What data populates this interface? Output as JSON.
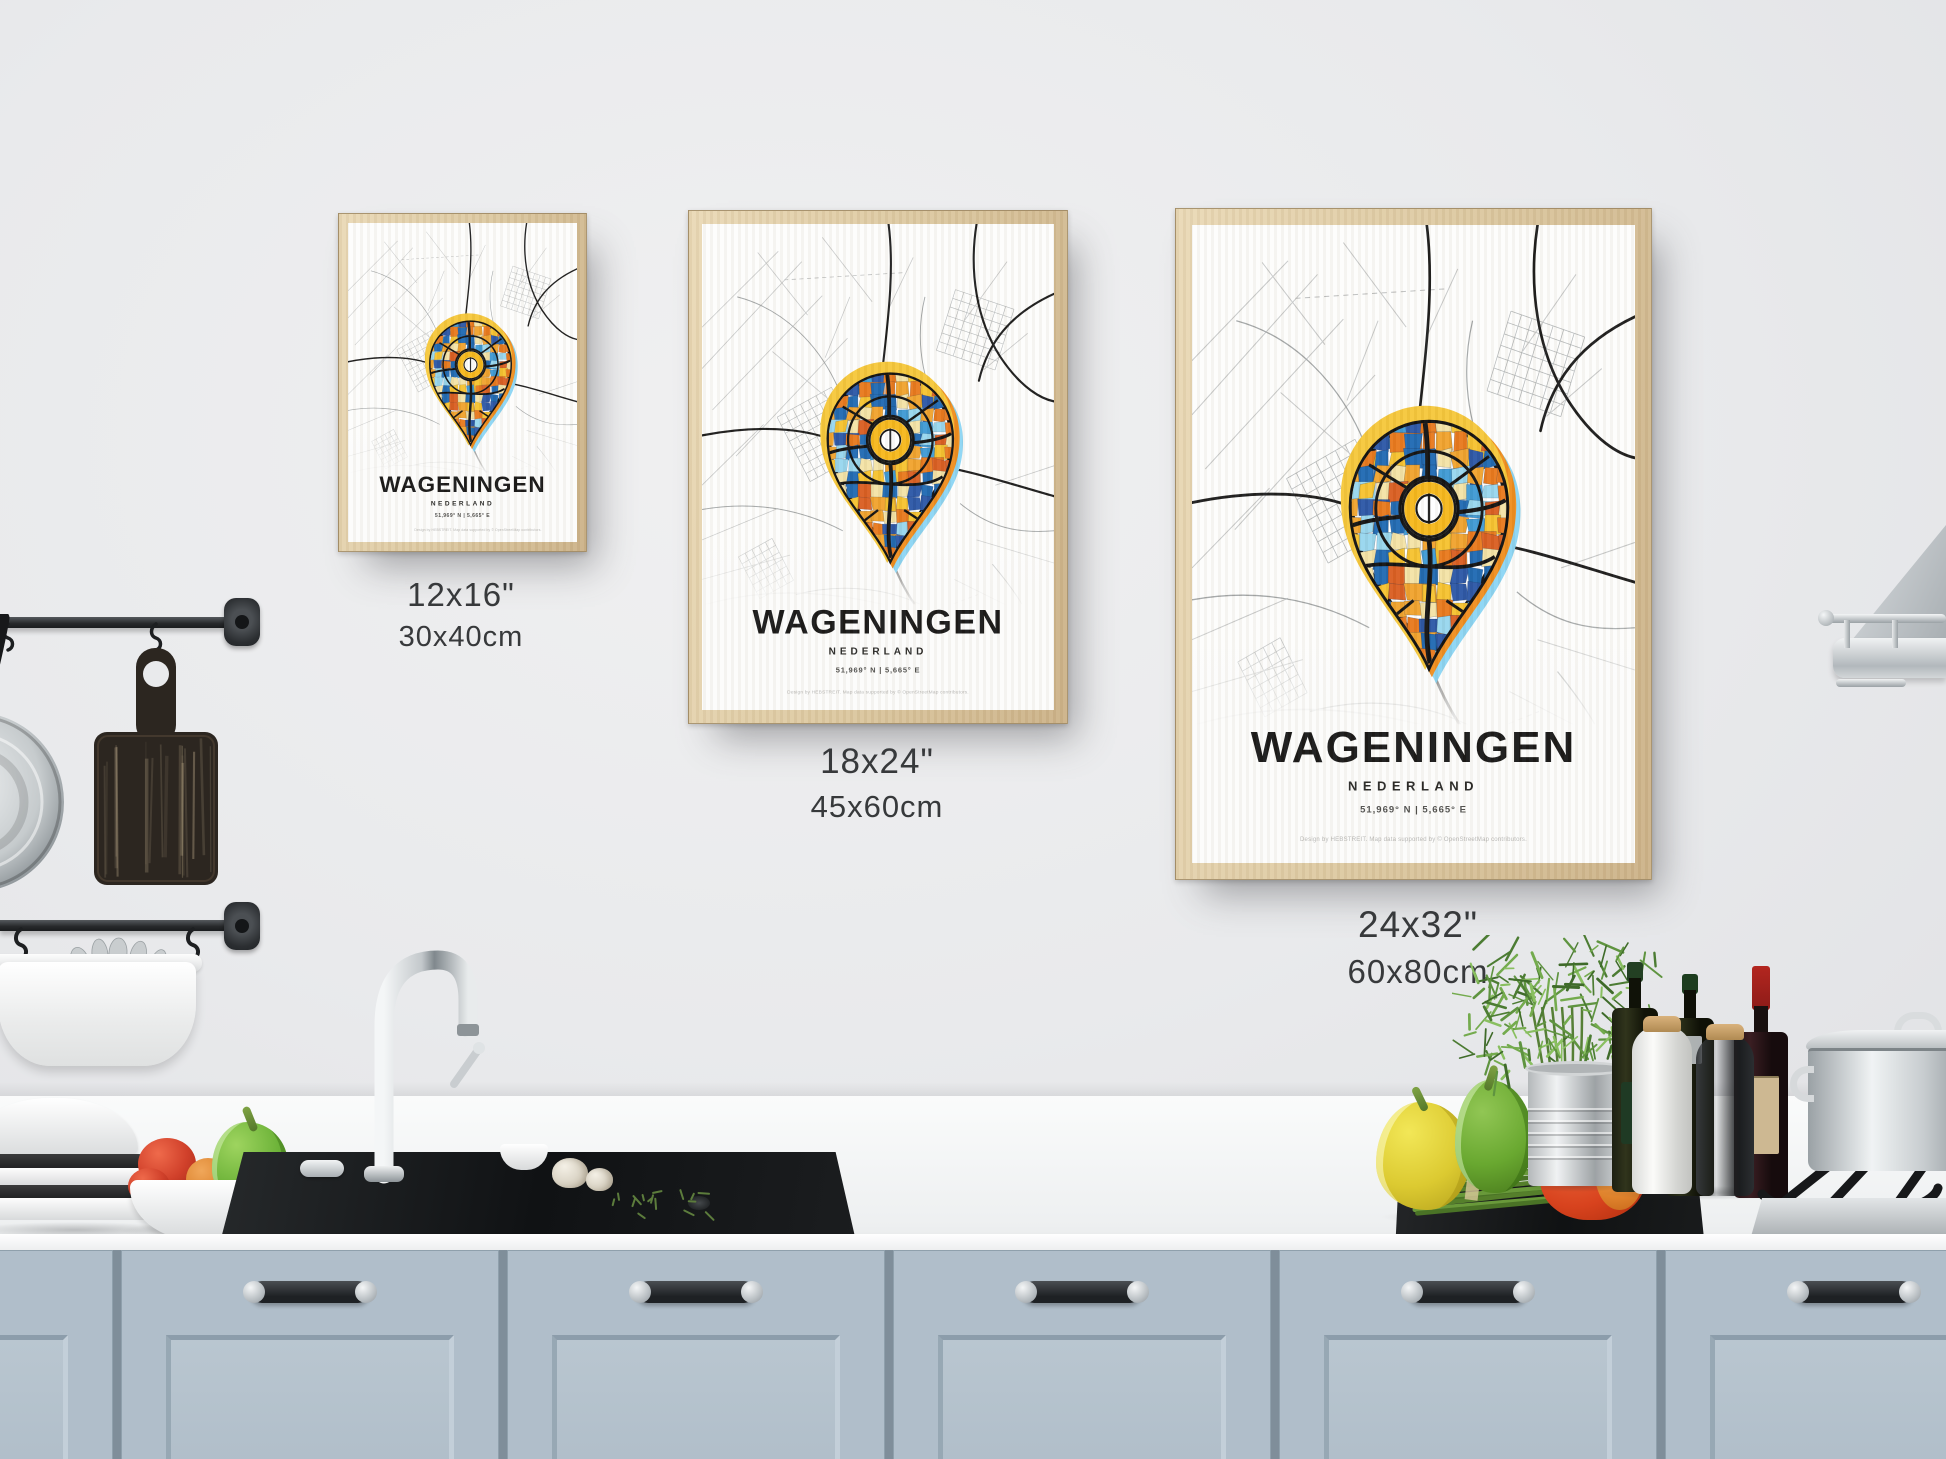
{
  "posters": {
    "title": "WAGENINGEN",
    "subtitle": "NEDERLAND",
    "coordinates": "51,969° N | 5,665° E",
    "credit": "Design by HEBSTREIT. Map data supported by © OpenStreetMap contributors."
  },
  "size_labels": [
    {
      "inches": "12x16\"",
      "cm": "30x40cm"
    },
    {
      "inches": "18x24\"",
      "cm": "45x60cm"
    },
    {
      "inches": "24x32\"",
      "cm": "60x80cm"
    }
  ],
  "colors": {
    "wall": "#e9eaec",
    "frame_wood": "#dcc8a0",
    "cabinet": "#b0beca",
    "counter": "#f5f6f7",
    "pin_yellow": "#f6c73a",
    "pin_orange": "#ef8d1d",
    "pin_blue": "#1e68b2",
    "pin_lightblue": "#8bd5f4",
    "map_road": "#1b1b1b"
  }
}
